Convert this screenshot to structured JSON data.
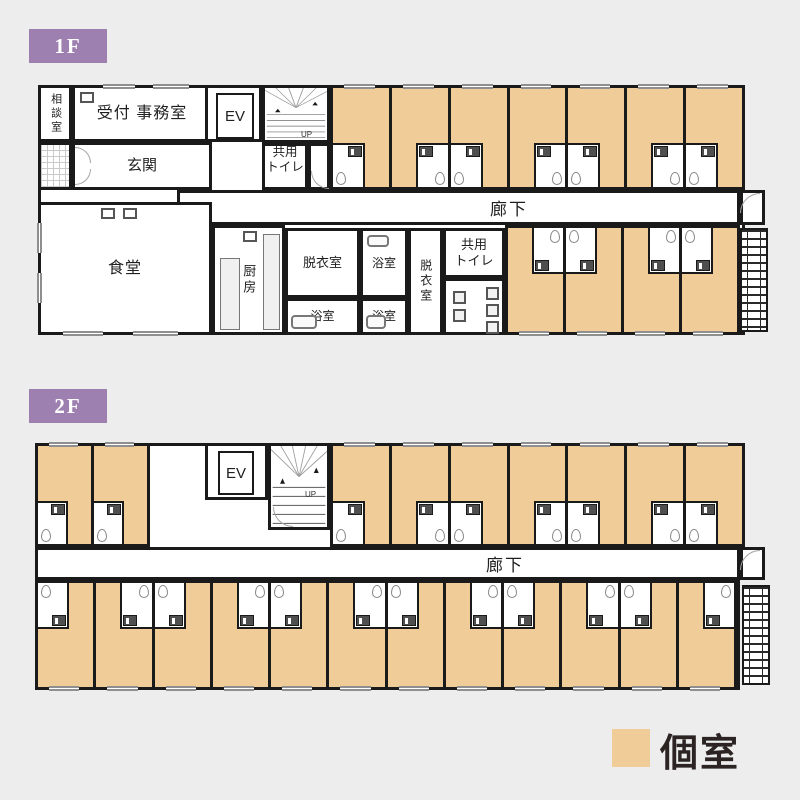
{
  "colors": {
    "background": "#ededee",
    "wall": "#1a1a1a",
    "private_room_fill": "#f0cd98",
    "floor_badge": "#9e80b0"
  },
  "floor1": {
    "badge": "1F",
    "consult_label": "相談室",
    "office_label": "受付 事務室",
    "elevator_label": "EV",
    "stairs_up_label": "UP",
    "shared_toilet_upper_label": "共用\nトイレ",
    "entrance_label": "玄関",
    "corridor_label": "廊下",
    "dining_label": "食堂",
    "kitchen_label": "厨房",
    "dressing_left_label": "脱衣室",
    "bath_upper_label": "浴室",
    "bath_lower_left_label": "浴室",
    "bath_lower_mid_label": "浴室",
    "dressing_right_label": "脱衣室",
    "shared_toilet_lower_label": "共用\nトイレ",
    "rooms": {
      "top_row": 7,
      "bottom_row": 4
    }
  },
  "floor2": {
    "badge": "2F",
    "elevator_label": "EV",
    "stairs_up_label": "UP",
    "corridor_label": "廊下",
    "rooms": {
      "top_left": 2,
      "top_row": 7,
      "bottom_row": 12
    }
  },
  "legend": {
    "label": "個室"
  }
}
